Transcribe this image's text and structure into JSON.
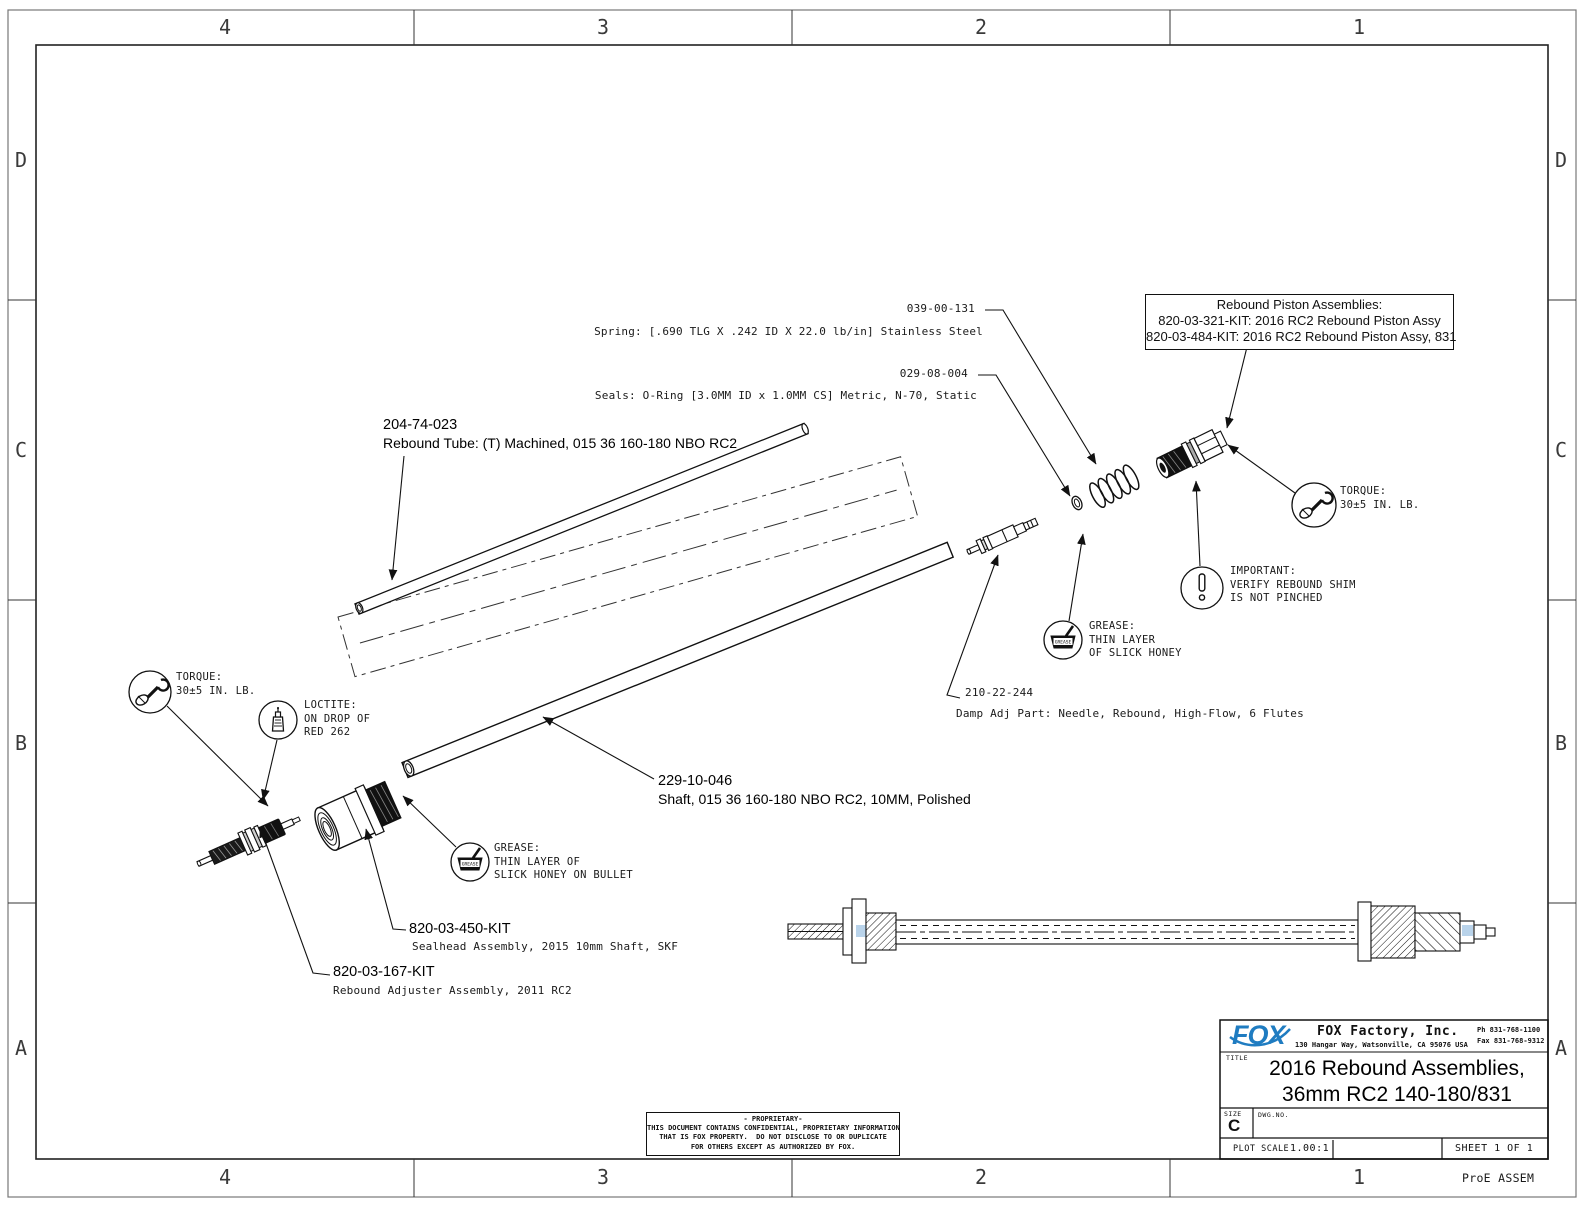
{
  "frame": {
    "zones_top": [
      "4",
      "3",
      "2",
      "1"
    ],
    "zones_bottom": [
      "4",
      "3",
      "2",
      "1"
    ],
    "zones_left": [
      "D",
      "C",
      "B",
      "A"
    ],
    "zones_right": [
      "D",
      "C",
      "B",
      "A"
    ],
    "footer_note": "ProE ASSEM"
  },
  "callouts": {
    "spring": {
      "part_no": "039-00-131",
      "desc": "Spring: [.690 TLG X .242 ID X 22.0 lb/in] Stainless Steel"
    },
    "seals": {
      "part_no": "029-08-004",
      "desc": "Seals: O-Ring [3.0MM ID x 1.0MM CS] Metric, N-70, Static"
    },
    "rebound_tube": {
      "part_no": "204-74-023",
      "desc": "Rebound Tube: (T) Machined, 015 36 160-180 NBO RC2"
    },
    "needle": {
      "part_no": "210-22-244",
      "desc": "Damp Adj Part: Needle, Rebound, High-Flow, 6 Flutes"
    },
    "shaft": {
      "part_no": "229-10-046",
      "desc": "Shaft, 015 36 160-180 NBO RC2, 10MM, Polished"
    },
    "sealhead": {
      "part_no": "820-03-450-KIT",
      "desc": "Sealhead Assembly, 2015 10mm Shaft, SKF"
    },
    "adjuster": {
      "part_no": "820-03-167-KIT",
      "desc": "Rebound Adjuster Assembly, 2011 RC2"
    }
  },
  "piston_box": {
    "title": "Rebound Piston Assemblies:",
    "line1": "820-03-321-KIT: 2016 RC2 Rebound Piston Assy",
    "line2": "820-03-484-KIT: 2016 RC2 Rebound Piston Assy, 831"
  },
  "notes": {
    "torque_right": {
      "l1": "TORQUE:",
      "l2": "30±5 IN. LB."
    },
    "torque_left": {
      "l1": "TORQUE:",
      "l2": "30±5 IN. LB."
    },
    "loctite": {
      "l1": "LOCTITE:",
      "l2": "ON DROP OF",
      "l3": "RED 262"
    },
    "grease_right": {
      "l1": "GREASE:",
      "l2": "THIN LAYER",
      "l3": "OF SLICK HONEY"
    },
    "grease_left": {
      "l1": "GREASE:",
      "l2": "THIN LAYER OF",
      "l3": "SLICK HONEY ON BULLET"
    },
    "important": {
      "l1": "IMPORTANT:",
      "l2": "VERIFY REBOUND SHIM",
      "l3": "IS NOT PINCHED"
    },
    "grease_icon_label": "GREASE"
  },
  "title_block": {
    "logo": "FOX",
    "company": "FOX Factory, Inc.",
    "address": "130 Hangar Way, Watsonville, CA 95076 USA",
    "phone": "Ph 831-768-1100",
    "fax": "Fax 831-768-9312",
    "title_label": "TITLE",
    "title_line1": "2016 Rebound Assemblies,",
    "title_line2": "36mm RC2 140-180/831",
    "size_label": "SIZE",
    "size_value": "C",
    "dwg_label": "DWG.NO.",
    "scale_label": "PLOT SCALE",
    "scale_value": "1.00:1",
    "sheet": "SHEET 1 OF 1",
    "brand_blue": "#1f7cc1"
  },
  "proprietary": {
    "l1": "- PROPRIETARY-",
    "l2": "THIS DOCUMENT CONTAINS CONFIDENTIAL, PROPRIETARY INFORMATION",
    "l3": "THAT IS FOX PROPERTY.  DO NOT DISCLOSE TO OR DUPLICATE",
    "l4": "FOR OTHERS EXCEPT AS AUTHORIZED BY FOX."
  }
}
